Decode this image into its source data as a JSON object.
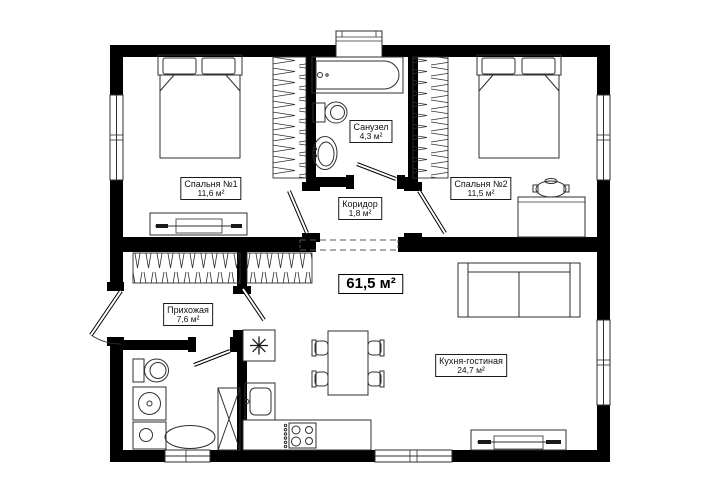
{
  "plan": {
    "total_area": "61,5 м²",
    "rooms": [
      {
        "name": "Спальня №1",
        "area": "11,6 м²"
      },
      {
        "name": "Санузел",
        "area": "4,3 м²"
      },
      {
        "name": "Спальня №2",
        "area": "11,5 м²"
      },
      {
        "name": "Коридор",
        "area": "1,8 м²"
      },
      {
        "name": "Прихожая",
        "area": "7,6 м²"
      },
      {
        "name": "Кухня-гостиная",
        "area": "24,7 м²"
      }
    ],
    "colors": {
      "wall": "#000000",
      "line": "#2f2f2f",
      "background": "#ffffff"
    }
  }
}
